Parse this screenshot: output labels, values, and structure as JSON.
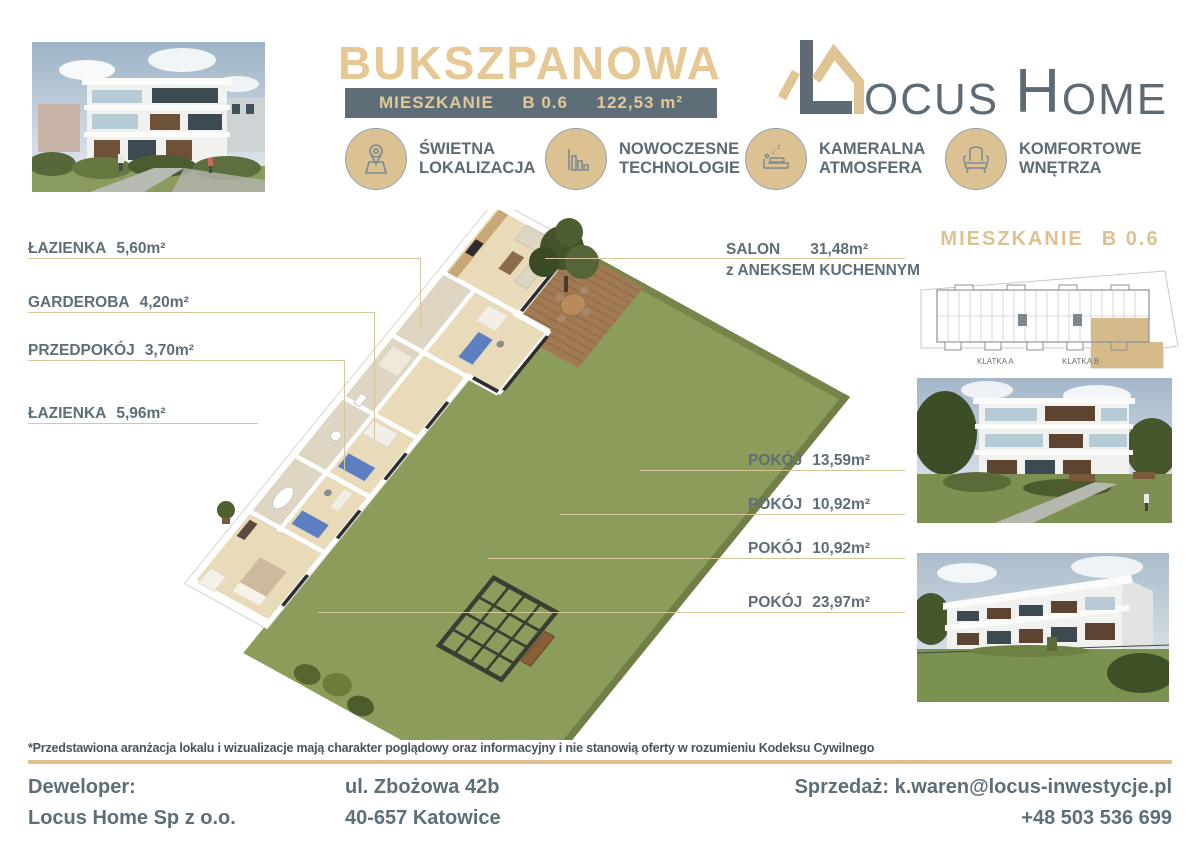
{
  "header": {
    "title": "BUKSZPANOWA",
    "unit_bar": {
      "label": "MIESZKANIE",
      "unit": "B 0.6",
      "area": "122,53 m²"
    },
    "logo": {
      "ocus": "OCUS",
      "h": "H",
      "ome": "OME"
    },
    "features": [
      {
        "icon": "location-pin-icon",
        "line1": "ŚWIETNA",
        "line2": "LOKALIZACJA"
      },
      {
        "icon": "bar-chart-icon",
        "line1": "NOWOCZESNE",
        "line2": "TECHNOLOGIE"
      },
      {
        "icon": "sleep-bed-icon",
        "line1": "KAMERALNA",
        "line2": "ATMOSFERA"
      },
      {
        "icon": "armchair-icon",
        "line1": "KOMFORTOWE",
        "line2": "WNĘTRZA"
      }
    ]
  },
  "plan": {
    "left_labels": [
      {
        "name": "ŁAZIENKA",
        "area": "5,60m²"
      },
      {
        "name": "GARDEROBA",
        "area": "4,20m²"
      },
      {
        "name": "PRZEDPOKÓJ",
        "area": "3,70m²"
      },
      {
        "name": "ŁAZIENKA",
        "area": "5,96m²"
      }
    ],
    "salon_label": {
      "name": "SALON",
      "area": "31,48m²",
      "subtitle": "z ANEKSEM KUCHENNYM"
    },
    "right_labels": [
      {
        "name": "POKÓJ",
        "area": "13,59m²"
      },
      {
        "name": "POKÓJ",
        "area": "10,92m²"
      },
      {
        "name": "POKÓJ",
        "area": "10,92m²"
      },
      {
        "name": "POKÓJ",
        "area": "23,97m²"
      }
    ]
  },
  "sidebar": {
    "title_label": "MIESZKANIE",
    "title_unit": "B 0.6",
    "stairwell_a": "KLATKA A",
    "stairwell_b": "KLATKA B"
  },
  "footer": {
    "disclaimer": "*Przedstawiona aranżacja lokalu i wizualizacje mają charakter poglądowy oraz informacyjny i nie stanowią oferty w rozumieniu Kodeksu Cywilnego",
    "developer_label": "Deweloper:",
    "developer_name": "Locus Home Sp z o.o.",
    "address_line1": "ul. Zbożowa 42b",
    "address_line2": "40-657 Katowice",
    "sales_label": "Sprzedaż:",
    "sales_email": "k.waren@locus-inwestycje.pl",
    "sales_phone": "+48 503 536 699"
  },
  "colors": {
    "tan": "#dfc494",
    "slate": "#5e6e78",
    "garden_green": "#8c9c5a"
  }
}
